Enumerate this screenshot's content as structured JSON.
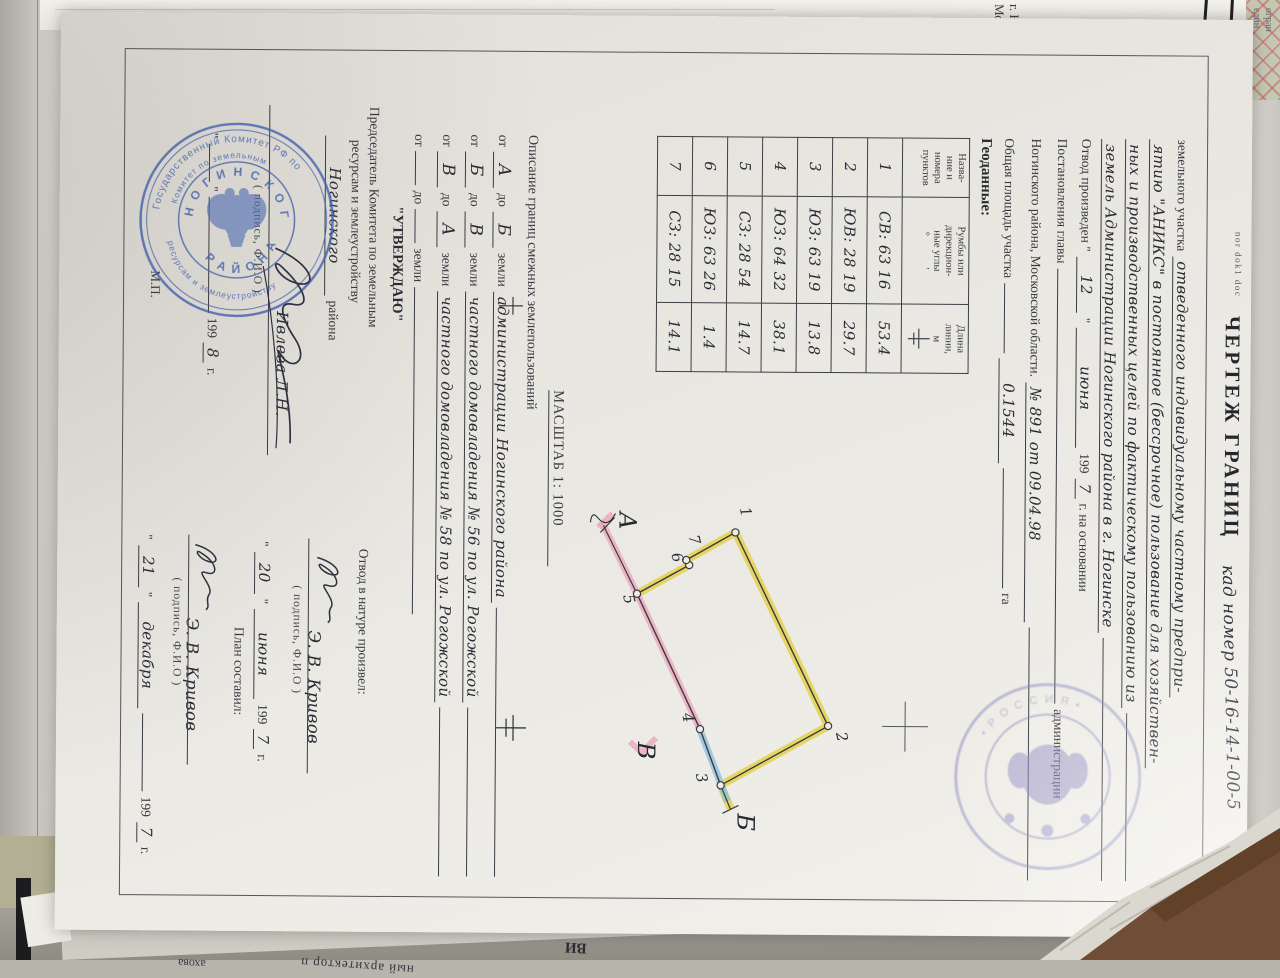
{
  "surroundings": {
    "top_sheet": {
      "line1": "г. Н",
      "line2": "Мос"
    },
    "corner_sheet": {
      "line1": "огран",
      "line2": "един"
    },
    "bottom_sheet": {
      "frag1": "ахова",
      "frag2": "ный архитектор п",
      "frag3": "ВИ"
    }
  },
  "doc": {
    "file_note": "nor dok1 doc",
    "title": {
      "printed": "ЧЕРТЕЖ ГРАНИЦ",
      "handwritten": "кад номер 50-16-14-1-00-5"
    },
    "intro": {
      "l1_p": "земельного участка",
      "l1_h": "отведенного индивидуальному частному предпри-",
      "l2_h": "ятию \"АНИКС\" в постоянное (бессрочное) пользование для хозяйствен-",
      "l3_h": "ных и производственных целей по фактическому пользованию из",
      "l4_h": "земель Администрации Ногинского района в г. Ногинске",
      "l5_p1": "Отвод произведен \"",
      "l5_h1": "12",
      "l5_p2": "\"",
      "l5_h2": "июня",
      "l5_p3": "199",
      "l5_h3": "7",
      "l5_p4": "г. на основании",
      "l6_p1": "Постановления главы",
      "l6_p2": "администрации",
      "l7_p1": "Ногинского района, Московской области.",
      "l7_h1": "№ 891 от 09.04.98",
      "l8_p1": "Общая площадь участка",
      "l8_h1": "0.1544",
      "l8_p2": "га"
    },
    "geodata": {
      "heading": "Геоданные:",
      "col1": "Назва-\nние и\nномера\nпунктов",
      "col2": "Румбы или\nдирекцион-\nные углы",
      "col2_units": "°            ′",
      "col3": "Длина\nлинии,\nм",
      "rows": [
        {
          "n": "1",
          "rumb": "СВ: 63 16",
          "len": "53.4"
        },
        {
          "n": "2",
          "rumb": "ЮВ: 28 19",
          "len": "29.7"
        },
        {
          "n": "3",
          "rumb": "ЮЗ: 63 19",
          "len": "13.8"
        },
        {
          "n": "4",
          "rumb": "ЮЗ: 64 32",
          "len": "38.1"
        },
        {
          "n": "5",
          "rumb": "СЗ: 28 54",
          "len": "14.7"
        },
        {
          "n": "6",
          "rumb": "ЮЗ: 63 26",
          "len": "1.4"
        },
        {
          "n": "7",
          "rumb": "СЗ: 28 15",
          "len": "14.1"
        }
      ]
    },
    "scale_label": "МАСШТАБ 1: 1000",
    "boundaries": {
      "heading": "Описание границ смежных землепользований",
      "from_word": "от",
      "to_word": "до",
      "land_word": "земли",
      "rows": [
        {
          "a": "А",
          "b": "Б",
          "hand": "администрации Ногинского района"
        },
        {
          "a": "Б",
          "b": "В",
          "hand": "частного домовладения № 56 по ул. Рогожской"
        },
        {
          "a": "В",
          "b": "А",
          "hand": "частного домовладения № 58 по ул. Рогожской"
        },
        {
          "a": "",
          "b": "",
          "hand": ""
        }
      ]
    },
    "plan": {
      "point_labels": [
        "1",
        "2",
        "3",
        "4",
        "5",
        "6",
        "7"
      ],
      "letter_a": "А",
      "letter_b": "Б",
      "letter_v": "В",
      "band_yellow": "#e2cd3a",
      "band_pink": "#eba8bd",
      "band_blue": "#8fc2dc"
    },
    "approve": {
      "title": "\"УТВЕРЖДАЮ\"",
      "line1": "Председатель Комитета по земельным",
      "line2": "ресурсам и землеустройству",
      "hand_district": "Ногинского",
      "district_suffix": "района",
      "name": "Ивлева Л.Н.",
      "sign_caption": "( подпись, Ф.И.О )",
      "date_q1": "\"",
      "date_q2": "\"",
      "date_year_p": "199",
      "date_year_h": "8",
      "date_g": "г.",
      "mp": "М.П."
    },
    "allot": {
      "heading": "Отвод в натуре произвел:",
      "name": "Э. В. Кривов",
      "sign_caption": "( подпись, Ф.И.О )",
      "d1_q1": "\"",
      "d1_day": "20",
      "d1_q2": "\"",
      "d1_month": "июня",
      "d1_year_p": "199",
      "d1_year_h": "7",
      "d1_g": "г.",
      "plan_heading": "План составил:",
      "name2": "Э. В. Кривов",
      "sign_caption2": "( подпись, Ф.И.О )",
      "d2_q1": "\"",
      "d2_day": "21",
      "d2_q2": "\"",
      "d2_month": "декабря",
      "d2_year_p": "199",
      "d2_year_h": "7",
      "d2_g": "г."
    },
    "stamp1": {
      "ring1": "Государственный Комитет РФ по",
      "ring2": "Комитет по земельным",
      "ring3": "ресурсам и землеустройству",
      "inner_top": "Н О Г И Н С К О Г О",
      "inner_bottom": "Р А Й О Н А"
    },
    "stamp2": {
      "ring": "• Р О С С И Я •"
    }
  }
}
